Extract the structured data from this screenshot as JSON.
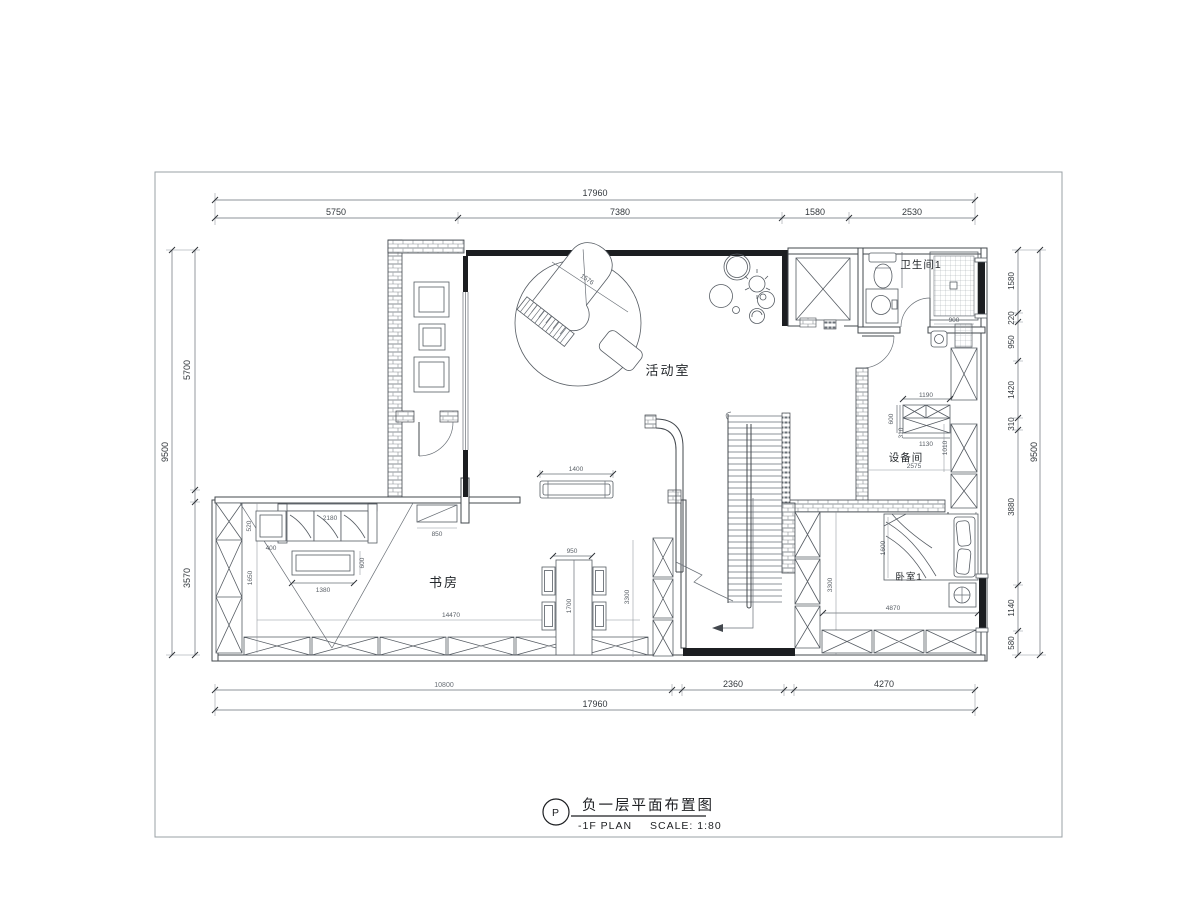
{
  "sheet": {
    "bg": "#ffffff",
    "frame_color": "#9aa0a6",
    "line_color": "#43484e",
    "wall_color": "#1c1e21"
  },
  "title_block": {
    "symbol": "P",
    "title": "负一层平面布置图",
    "plan_label": "-1F PLAN",
    "scale_label": "SCALE: 1:80"
  },
  "rooms": {
    "activity": "活动室",
    "study": "书房",
    "bathroom": "卫生间1",
    "equipment": "设备间",
    "bedroom": "卧室1"
  },
  "dims": {
    "top": {
      "overall": "17960",
      "seg1": "5750",
      "seg2": "7380",
      "seg3": "1580",
      "seg4": "2530"
    },
    "bottom": {
      "overall": "17960",
      "seg1": "10800",
      "seg2": "2360",
      "seg3": "4270"
    },
    "left": {
      "overall": "9500",
      "seg1": "5700",
      "seg2": "3570"
    },
    "right": {
      "overall": "9500",
      "seg1": "1580",
      "seg2": "220",
      "seg3": "950",
      "seg4": "1420",
      "seg5": "310",
      "seg6": "3880",
      "seg7": "1140",
      "seg8": "580"
    },
    "interior": {
      "piano": "1576",
      "bench": "1400",
      "sofa": "2180",
      "side_table_w": "520",
      "side_table_d": "400",
      "coffee_table_w": "1380",
      "coffee_table_d": "600",
      "study_height": "1650",
      "study_width": "14470",
      "table_w": "950",
      "table_l": "1700",
      "dining_wall": "3300",
      "cabinet": "850",
      "equip_top": "1190",
      "equip_depth": "600",
      "equip_gap": "310",
      "equip_mid": "1130",
      "equip_width": "2575",
      "equip_side": "1010",
      "bed_width": "1600",
      "bedroom_width": "4870",
      "bedroom_wall": "3300",
      "shower": "900"
    }
  }
}
